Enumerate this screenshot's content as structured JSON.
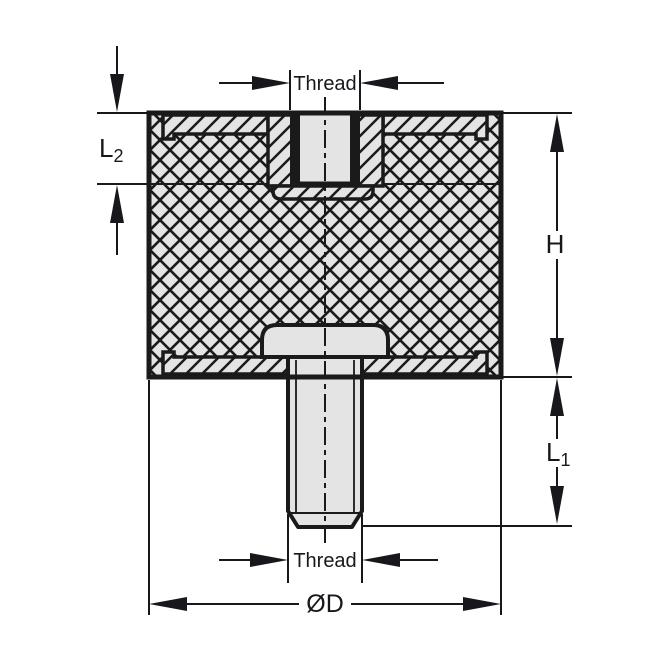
{
  "diagram": {
    "labels": {
      "thread_top": "Thread",
      "thread_bottom": "Thread",
      "l2": {
        "main": "L",
        "sub": "2"
      },
      "h": "H",
      "l1": {
        "main": "L",
        "sub": "1"
      },
      "diameter": "ØD"
    },
    "colors": {
      "line": "#1a1a1a",
      "part_fill": "#e4e4e4",
      "background": "#ffffff",
      "text": "#17171c"
    }
  }
}
